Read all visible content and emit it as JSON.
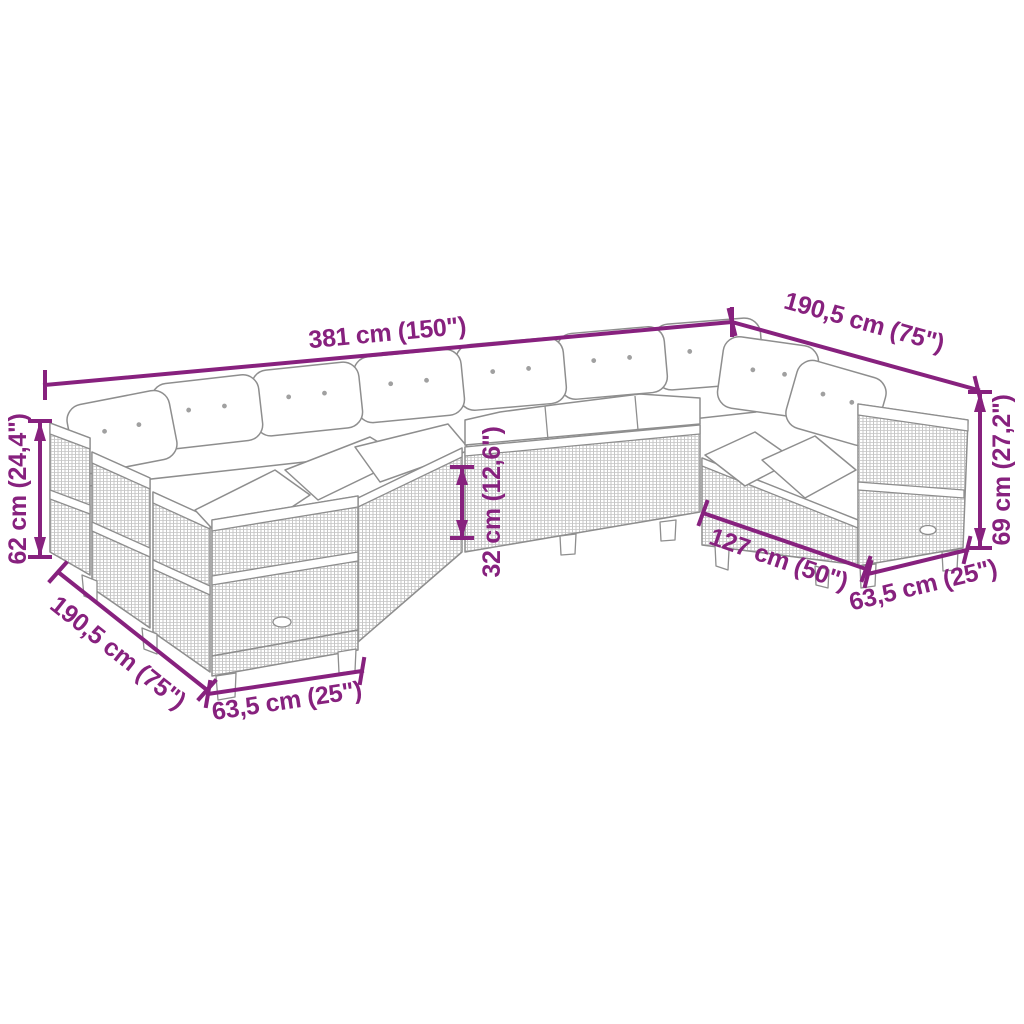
{
  "diagram": {
    "type": "product-dimension-diagram",
    "product": "U-shaped garden lounge sofa set with cushions",
    "colors": {
      "dimension": "#87217e",
      "sketch": "#8e8e8e",
      "background": "#ffffff"
    },
    "dimensions": {
      "back_total_width": {
        "label": "381 cm (150\")"
      },
      "right_side_depth": {
        "label": "190,5 cm (75\")"
      },
      "backrest_height": {
        "label": "62 cm (24,4\")"
      },
      "seat_height": {
        "label": "32 cm (12,6\")"
      },
      "armrest_height": {
        "label": "69 cm (27,2\")"
      },
      "right_inner_width": {
        "label": "127 cm (50\")"
      },
      "right_module_width": {
        "label": "63,5 cm (25\")"
      },
      "left_side_depth": {
        "label": "190,5 cm (75\")"
      },
      "left_module_width": {
        "label": "63,5 cm (25\")"
      }
    }
  }
}
